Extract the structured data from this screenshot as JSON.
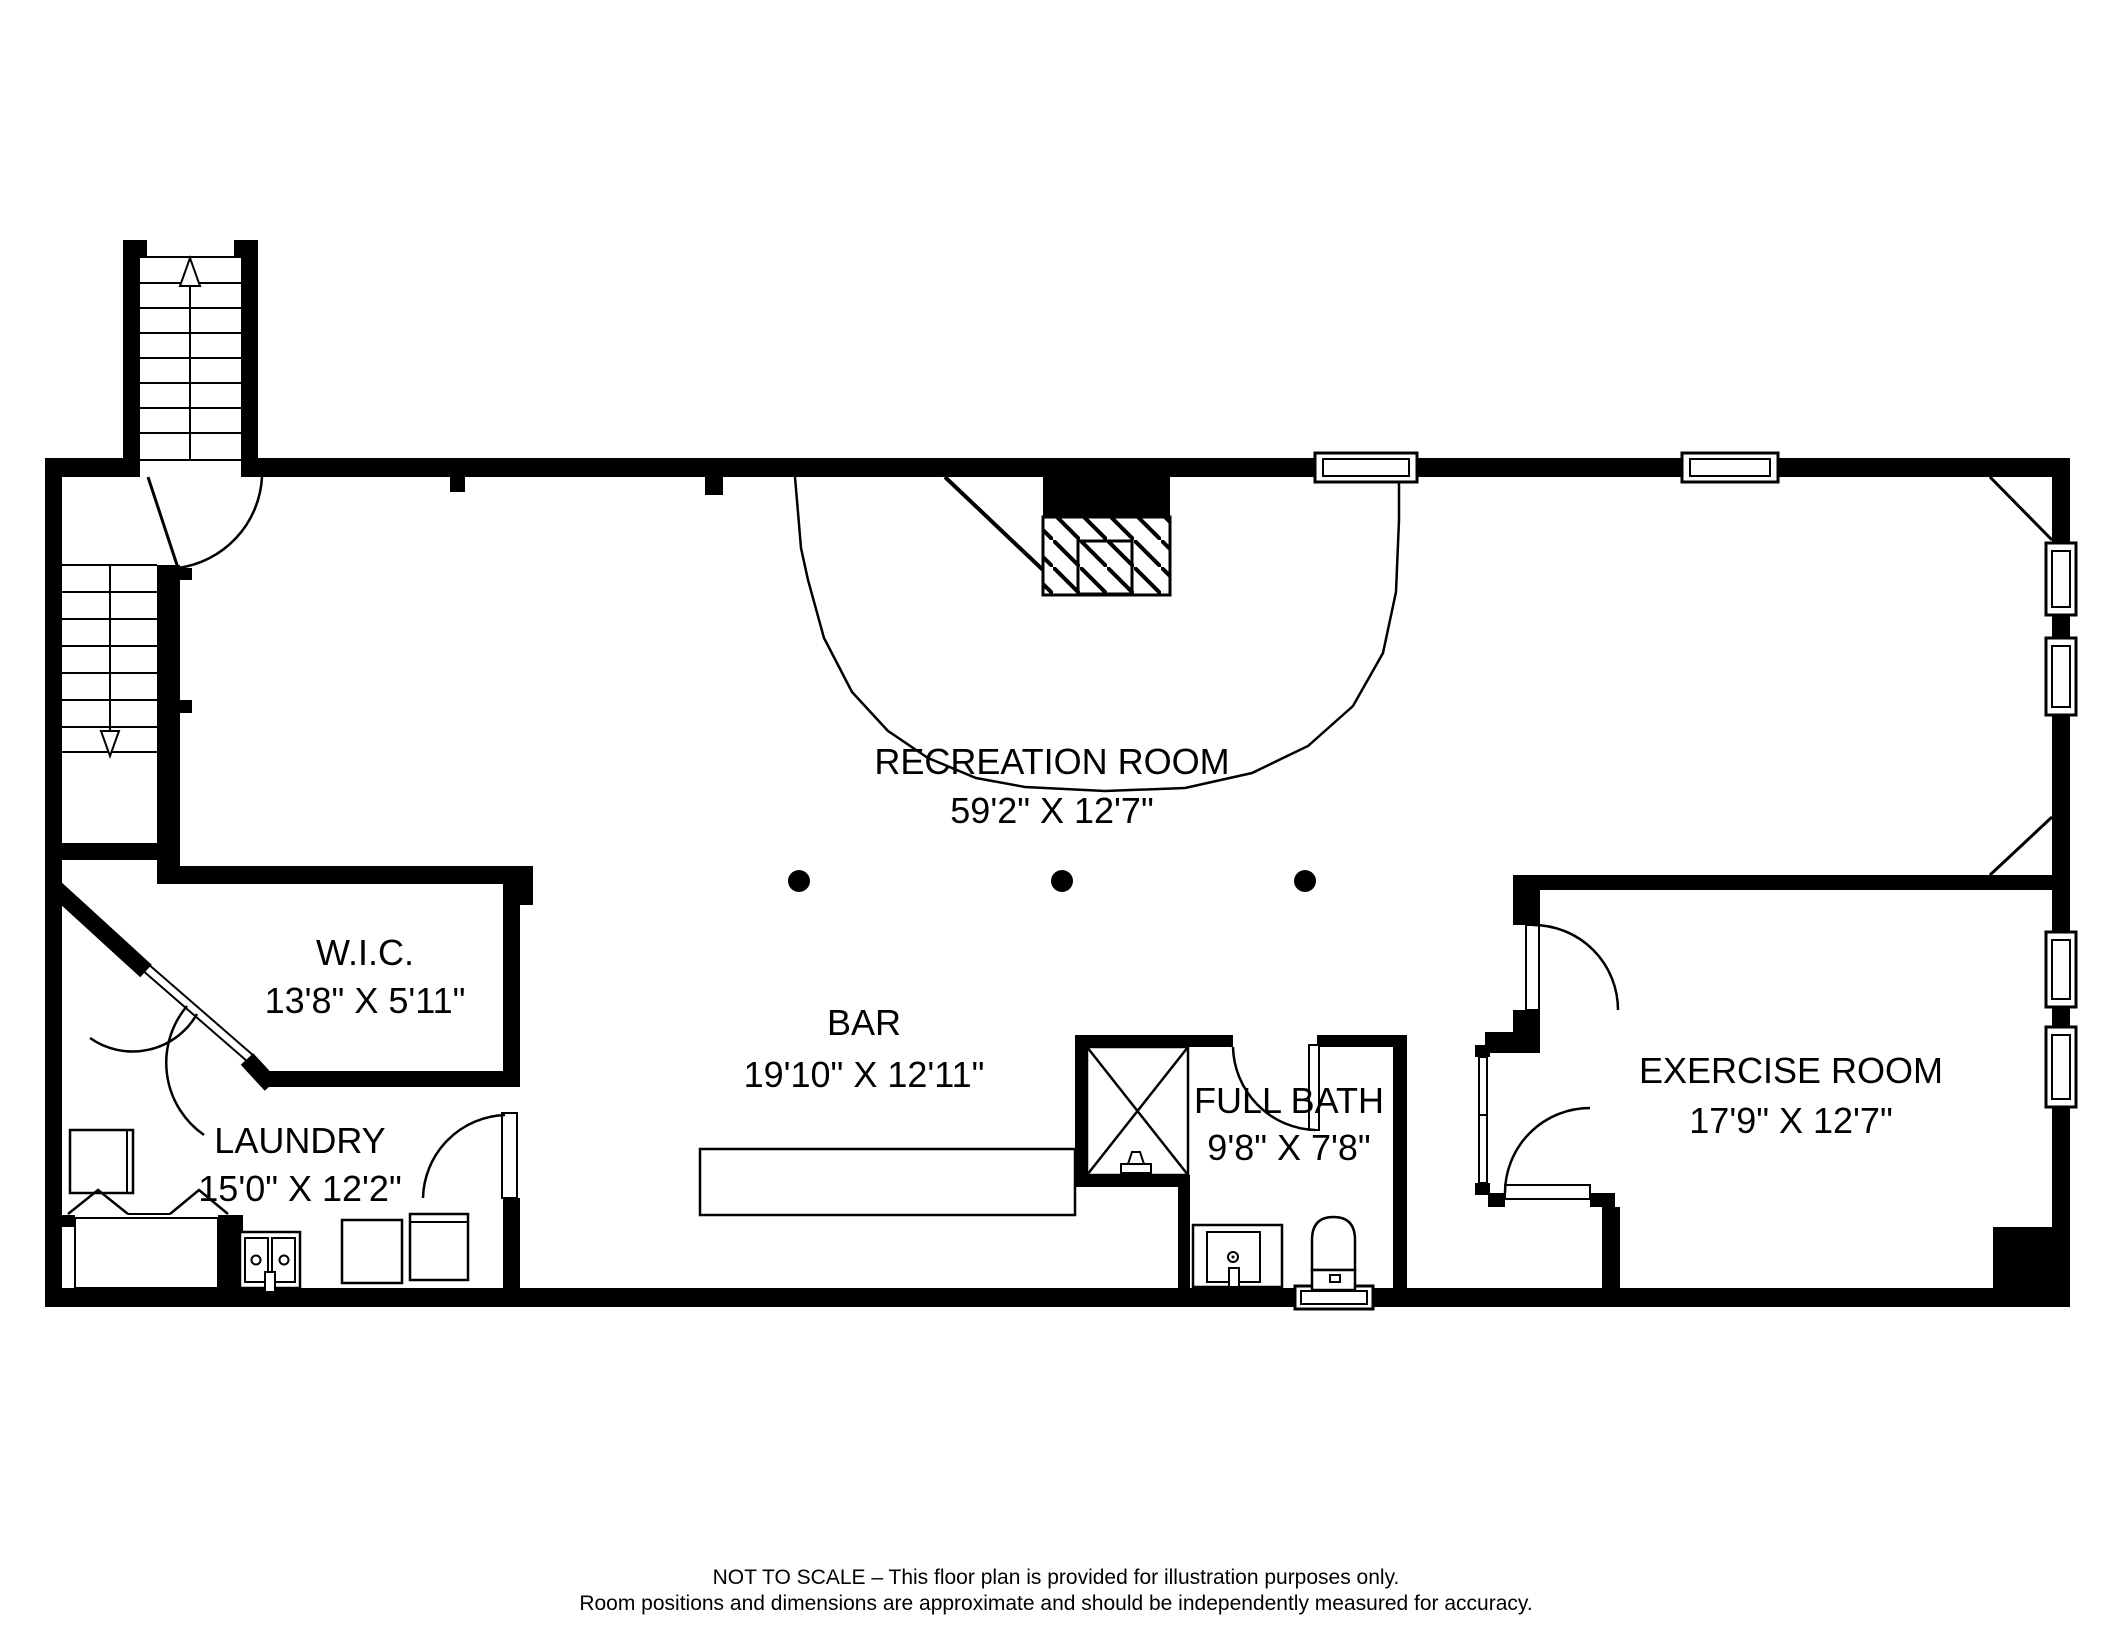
{
  "plan": {
    "title": "Basement floor plan",
    "colors": {
      "wall": "#000000",
      "background": "#ffffff",
      "line": "#000000"
    },
    "rooms": [
      {
        "id": "recreation-room",
        "name": "RECREATION ROOM",
        "dims": "59'2\" X 12'7\""
      },
      {
        "id": "wic",
        "name": "W.I.C.",
        "dims": "13'8\" X 5'11\""
      },
      {
        "id": "laundry",
        "name": "LAUNDRY",
        "dims": "15'0\" X 12'2\""
      },
      {
        "id": "bar",
        "name": "BAR",
        "dims": "19'10\" X 12'11\""
      },
      {
        "id": "full-bath",
        "name": "FULL BATH",
        "dims": "9'8\" X 7'8\""
      },
      {
        "id": "exercise-room",
        "name": "EXERCISE ROOM",
        "dims": "17'9\" X 12'7\""
      }
    ],
    "icons": {
      "stairs_up_arrow": "hollow triangle pointing up",
      "stairs_down_arrow": "hollow triangle pointing down",
      "fireplace": "hatched hearth box",
      "shower": "X-crossed stall",
      "columns": "3 filled dots"
    },
    "footer": {
      "line1": "NOT TO SCALE – This floor plan is provided for illustration purposes only.",
      "line2": "Room positions and dimensions are approximate and should be independently measured for accuracy."
    }
  }
}
